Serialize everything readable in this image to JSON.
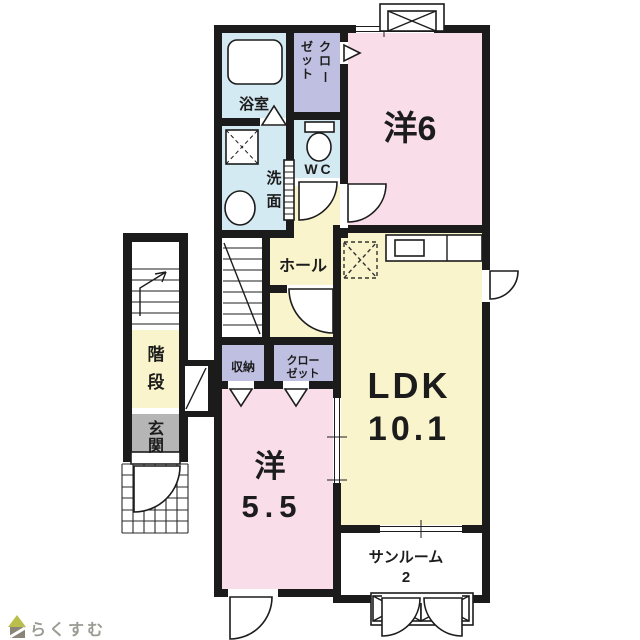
{
  "palette": {
    "wall": "#1b1b1b",
    "room_pink": "#f9dde9",
    "room_yellow": "#f9f4cb",
    "room_blue": "#d3eaf2",
    "closet_lavender": "#bfbfe1",
    "entry_gray": "#b5b5b5",
    "logo_green": "#b9bf4a",
    "logo_gray": "#8a8578",
    "logo_text": "#9b9b93"
  },
  "floorplan": {
    "rooms": {
      "bath": {
        "label": "浴室"
      },
      "washroom": {
        "label": "洗面",
        "chars": [
          "洗",
          "面"
        ]
      },
      "wc": {
        "label": "WC"
      },
      "closet_top": {
        "label": "クローゼット",
        "right_col": [
          "ク",
          "ロ",
          "ー"
        ],
        "left_col": [
          "ゼ",
          "ッ",
          "ト"
        ]
      },
      "western6": {
        "label": "洋6"
      },
      "hall": {
        "label": "ホール"
      },
      "ldk": {
        "label": "LDK",
        "size": "10.1"
      },
      "storage": {
        "label": "収納"
      },
      "closet_lower": {
        "line1": "クロー",
        "line2": "ゼット"
      },
      "western55": {
        "label": "洋",
        "size": "5.5"
      },
      "sunroom": {
        "label": "サンルーム",
        "size": "2"
      },
      "stairs": {
        "label": "階段",
        "chars": [
          "階",
          "段"
        ]
      },
      "entrance": {
        "label": "玄関",
        "chars": [
          "玄",
          "関"
        ]
      }
    },
    "logo": {
      "text": "らくすむ"
    }
  }
}
